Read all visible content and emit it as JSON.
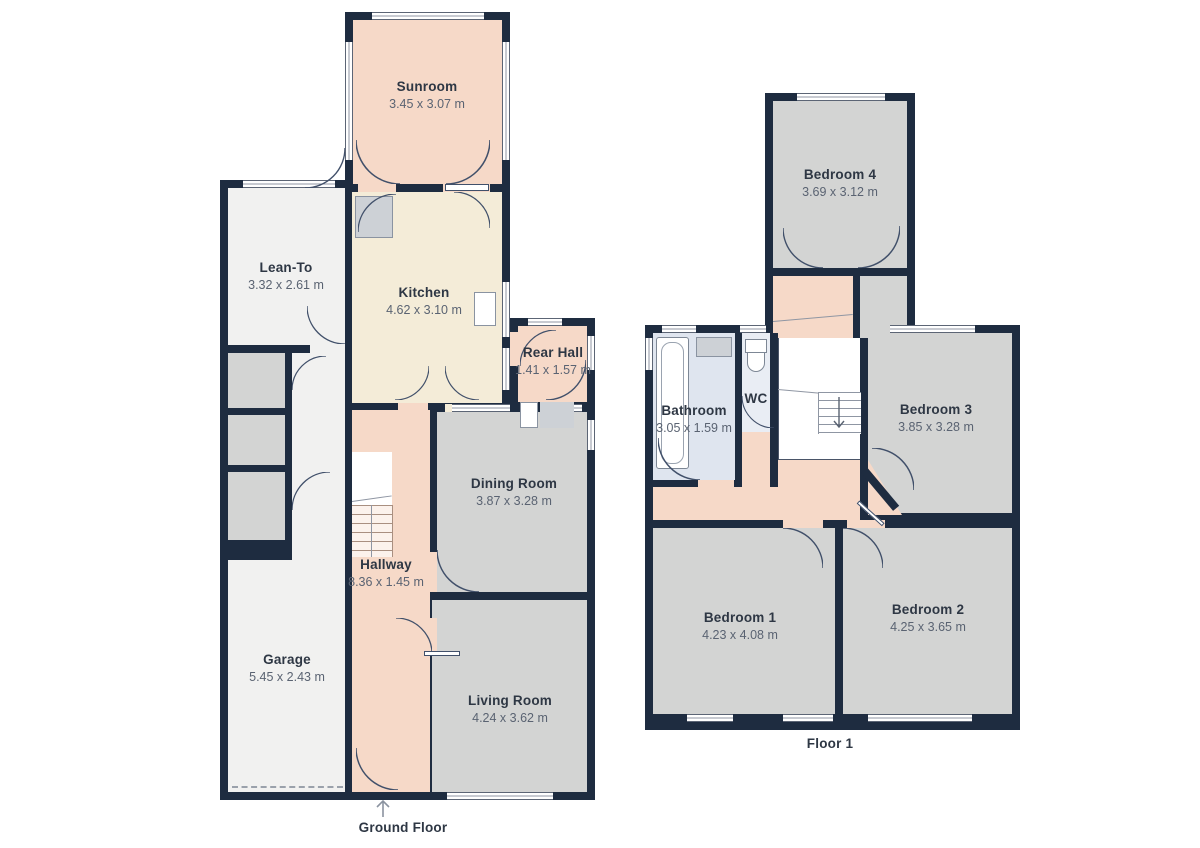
{
  "title": "Floor plan",
  "floors": [
    {
      "label": "Ground Floor",
      "rooms": [
        {
          "name": "Sunroom",
          "dims": "3.45 x 3.07 m"
        },
        {
          "name": "Lean-To",
          "dims": "3.32 x 2.61 m"
        },
        {
          "name": "Kitchen",
          "dims": "4.62 x 3.10 m"
        },
        {
          "name": "Rear Hall",
          "dims": "1.41 x 1.57 m"
        },
        {
          "name": "Dining Room",
          "dims": "3.87 x 3.28 m"
        },
        {
          "name": "Hallway",
          "dims": "8.36 x 1.45 m"
        },
        {
          "name": "Garage",
          "dims": "5.45 x 2.43 m"
        },
        {
          "name": "Living Room",
          "dims": "4.24 x 3.62 m"
        }
      ]
    },
    {
      "label": "Floor 1",
      "rooms": [
        {
          "name": "Bedroom 4",
          "dims": "3.69 x 3.12 m"
        },
        {
          "name": "Bathroom",
          "dims": "3.05 x 1.59 m"
        },
        {
          "name": "WC",
          "dims": ""
        },
        {
          "name": "Bedroom 3",
          "dims": "3.85 x 3.28 m"
        },
        {
          "name": "Bedroom 1",
          "dims": "4.23 x 4.08 m"
        },
        {
          "name": "Bedroom 2",
          "dims": "4.25 x 3.65 m"
        }
      ]
    }
  ],
  "colors": {
    "background": "#ffffff",
    "wall": "#1e2c40",
    "room_gray": "#d3d4d3",
    "room_lightgray": "#f1f1f0",
    "room_salmon": "#f6d9c8",
    "room_cream": "#f4ecd8",
    "room_blue": "#dfe5ef",
    "room_blue_light": "#e9edf4",
    "room_white": "#ffffff",
    "fixture_gray": "#cdd1d6",
    "door_line": "#41506a",
    "window_line": "#8f96a3"
  }
}
